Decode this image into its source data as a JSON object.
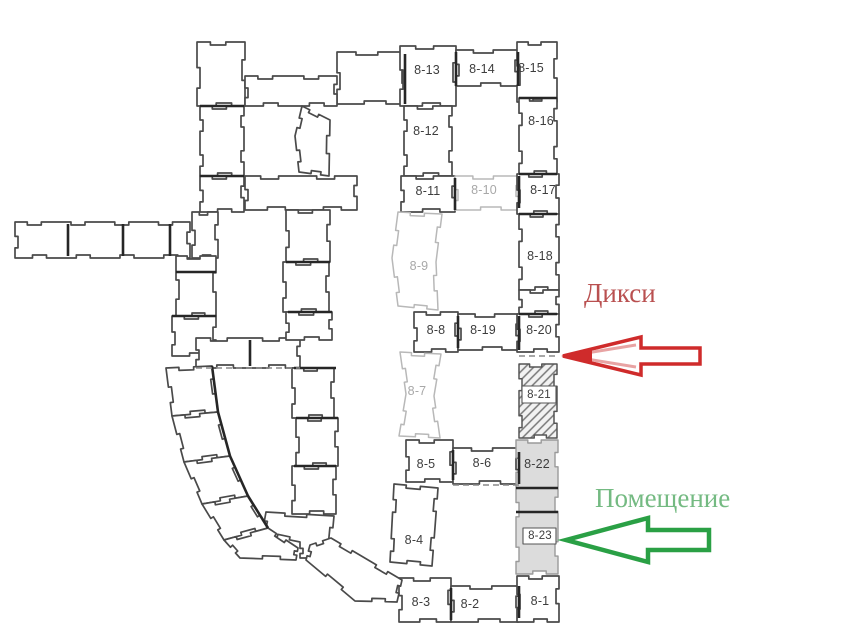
{
  "rooms": {
    "r8_13": "8-13",
    "r8_14": "8-14",
    "r8_15": "8-15",
    "r8_12": "8-12",
    "r8_16": "8-16",
    "r8_11": "8-11",
    "r8_10": "8-10",
    "r8_17": "8-17",
    "r8_9": "8-9",
    "r8_18": "8-18",
    "r8_8": "8-8",
    "r8_19": "8-19",
    "r8_20": "8-20",
    "r8_7": "8-7",
    "r8_21": "8-21",
    "r8_5": "8-5",
    "r8_6": "8-6",
    "r8_22": "8-22",
    "r8_4": "8-4",
    "r8_23": "8-23",
    "r8_3": "8-3",
    "r8_2": "8-2",
    "r8_1": "8-1"
  },
  "annotations": {
    "dixie_label": "Дикси",
    "premises_label": "Помещение",
    "dixie_color": "#b95050",
    "premises_color": "#74ba82",
    "red_arrow_color": "#cf2b2b",
    "red_arrow_inner": "#e8a3a3",
    "green_arrow_color": "#2aa045"
  },
  "plan_colors": {
    "wall_dark": "#4a4a4a",
    "wall_light": "#b8b8b8",
    "shade_fill": "#dcdcdc",
    "divider": "#262626"
  }
}
